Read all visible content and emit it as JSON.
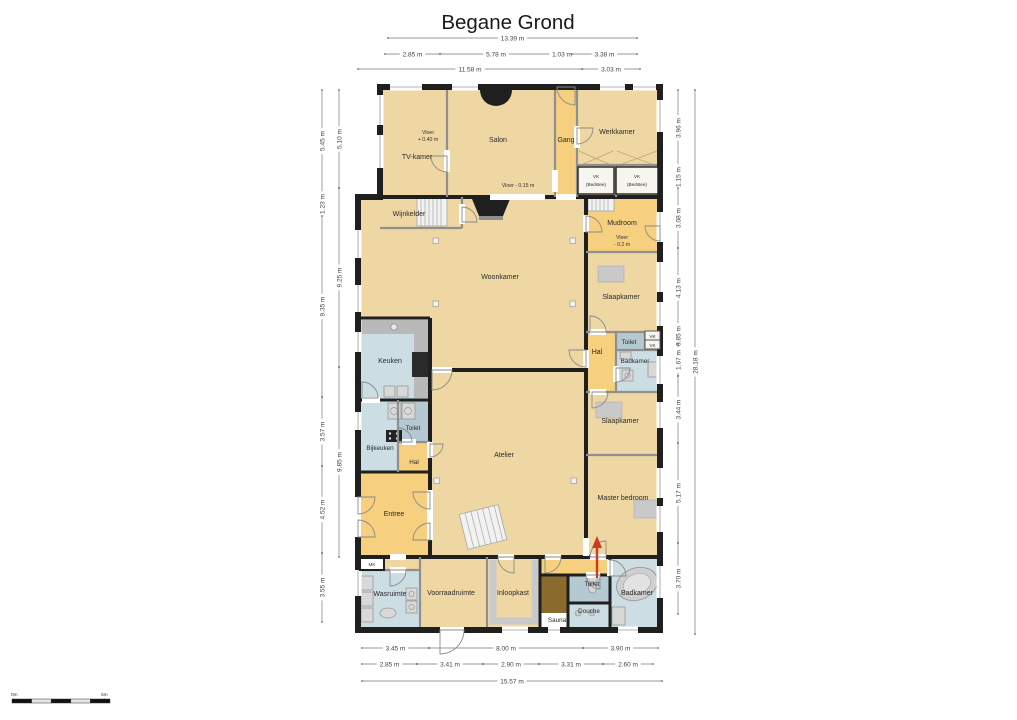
{
  "title": "Begane Grond",
  "scale_bar": {
    "start": "0m",
    "end": "5m"
  },
  "rooms": {
    "tv_kamer": "TV-kamer",
    "salon": "Salon",
    "gang": "Gang",
    "werkkamer": "Werkkamer",
    "vk_bedstee": {
      "l1": "VK",
      "l2": "(Bedstee)"
    },
    "wijnkelder": "Wijnkelder",
    "mudroom": "Mudroom",
    "woonkamer": "Woonkamer",
    "slaapkamer_1": "Slaapkamer",
    "toilet_1": "Toilet",
    "vk": "VK",
    "badkamer_1": "Badkamer",
    "hal_1": "Hal",
    "keuken": "Keuken",
    "bijkeuken": "Bijkeuken",
    "toilet_2": "Toilet",
    "hal_2": "Hal",
    "atelier": "Atelier",
    "entree": "Entree",
    "slaapkamer_2": "Slaapkamer",
    "master_bedroom": "Master bedroom",
    "mk": "MK",
    "wasruimte": "Wasruimte",
    "voorraadruimte": "Voorraadruimte",
    "inloopkast": "Inloopkast",
    "sauna": "Sauna",
    "toilet_3": "Toilet",
    "douche": "Douche",
    "badkamer_2": "Badkamer"
  },
  "annotations": {
    "vloer_tv": {
      "l1": "Vloer",
      "l2": "+ 0.40 m"
    },
    "vloer_salon": "Vloer - 0.15 m",
    "vloer_mudroom": {
      "l1": "Vloer",
      "l2": "- 0.2 m"
    }
  },
  "dimensions": {
    "top": {
      "row1": [
        "13.39 m"
      ],
      "row2": [
        "2.85 m",
        "5.78 m",
        "1.03 m",
        "3.38 m"
      ],
      "row3": [
        "11.58 m",
        "3.03 m"
      ]
    },
    "bottom": {
      "row1": [
        "3.45 m",
        "8.00 m",
        "3.90 m"
      ],
      "row2": [
        "2.85 m",
        "3.41 m",
        "2.90 m",
        "3.31 m",
        "2.60 m"
      ],
      "row3": [
        "15.57 m"
      ]
    },
    "left": {
      "outer": [
        "5.45 m",
        "1.23 m",
        "9.35 m",
        "3.57 m",
        "4.52 m",
        "3.55 m"
      ],
      "inner": [
        "5.10 m",
        "9.25 m",
        "9.85 m"
      ]
    },
    "right": {
      "inner": [
        "3.96 m",
        "1.15 m",
        "3.08 m",
        "4.13 m",
        "0.85 m",
        "1.67 m",
        "3.44 m",
        "5.17 m",
        "3.70 m"
      ],
      "outer": [
        "28.18 m"
      ]
    }
  },
  "colors": {
    "floor_tan": "#efd7a4",
    "floor_orange": "#f6cf7f",
    "floor_blue": "#ccdde3",
    "floor_toilet": "#b4c9d2",
    "sauna_brown": "#8a6a2d",
    "wall": "#1f1f1f",
    "entrance_arrow": "#cf3a1e"
  }
}
